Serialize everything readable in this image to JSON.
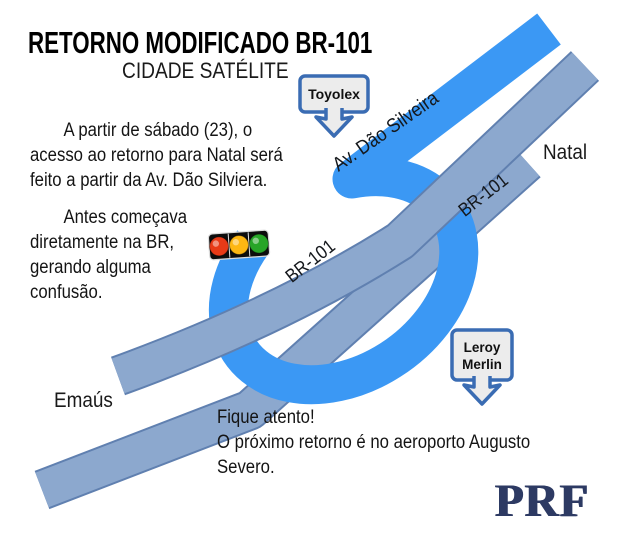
{
  "header": {
    "title": "RETORNO MODIFICADO  BR-101",
    "subtitle": "CIDADE SATÉLITE"
  },
  "body_text": {
    "paragraph1": "A partir de sábado (23), o\nacesso ao retorno para Natal será\nfeito a partir da Av. Dão Silviera.",
    "paragraph2": "Antes começava\ndiretamente na BR,\ngerando alguma\nconfusão.",
    "alert": "Fique atento!\nO próximo retorno é no aeroporto Augusto Severo."
  },
  "map": {
    "road_label_avenue": "Av. Dão Silveira",
    "road_label_br101_west": "BR-101",
    "road_label_br101_east": "BR-101",
    "place_natal": "Natal",
    "place_emaus": "Emaús",
    "sign_toyolex": "Toyolex",
    "sign_leroy_line1": "Leroy",
    "sign_leroy_line2": "Merlin"
  },
  "footer": {
    "logo": "PRF"
  },
  "colors": {
    "avenue_blue": "#3b98f4",
    "highway_gray_blue": "#8ca8ce",
    "highway_border": "#6080b0",
    "sign_border_blue": "#3a6cb3",
    "sign_fill": "#ececec",
    "logo_navy": "#2d3a63",
    "traffic_red": "#e83a17",
    "traffic_amber": "#fdb713",
    "traffic_green": "#27a527"
  }
}
